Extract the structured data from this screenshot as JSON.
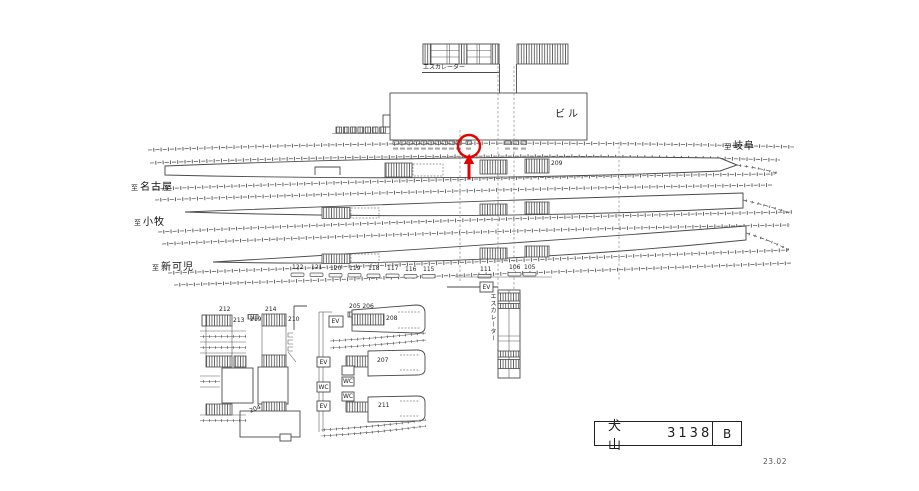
{
  "title_box": {
    "station": "犬　山",
    "number": "3138",
    "suffix": "B"
  },
  "revision": "23.02",
  "marker": {
    "color": "#e60000"
  },
  "directions": {
    "gifu": {
      "prefix": "至",
      "name": "岐阜"
    },
    "nagoya": {
      "prefix": "至",
      "name": "名古屋"
    },
    "komaki": {
      "prefix": "至",
      "name": "小牧"
    },
    "shinkani": {
      "prefix": "至",
      "name": "新可児"
    }
  },
  "structures": {
    "building": "ビル",
    "escalator_upper": "エスカレーター",
    "escalator_center": "エスカレーター"
  },
  "facilities": {
    "elevator": "EV",
    "toilet": "WC"
  },
  "positions": {
    "p209": "209",
    "row_left": [
      "122",
      "121",
      "120",
      "119",
      "118",
      "117",
      "116",
      "115"
    ],
    "row_center": "111",
    "row_right": [
      "106",
      "105"
    ],
    "west": {
      "n212": "212",
      "n213": "213",
      "n219": "219",
      "n214": "214",
      "n210": "210",
      "n204": "204"
    },
    "east": {
      "n205_206": "205 206",
      "n208": "208",
      "n207": "207",
      "n211": "211"
    }
  }
}
